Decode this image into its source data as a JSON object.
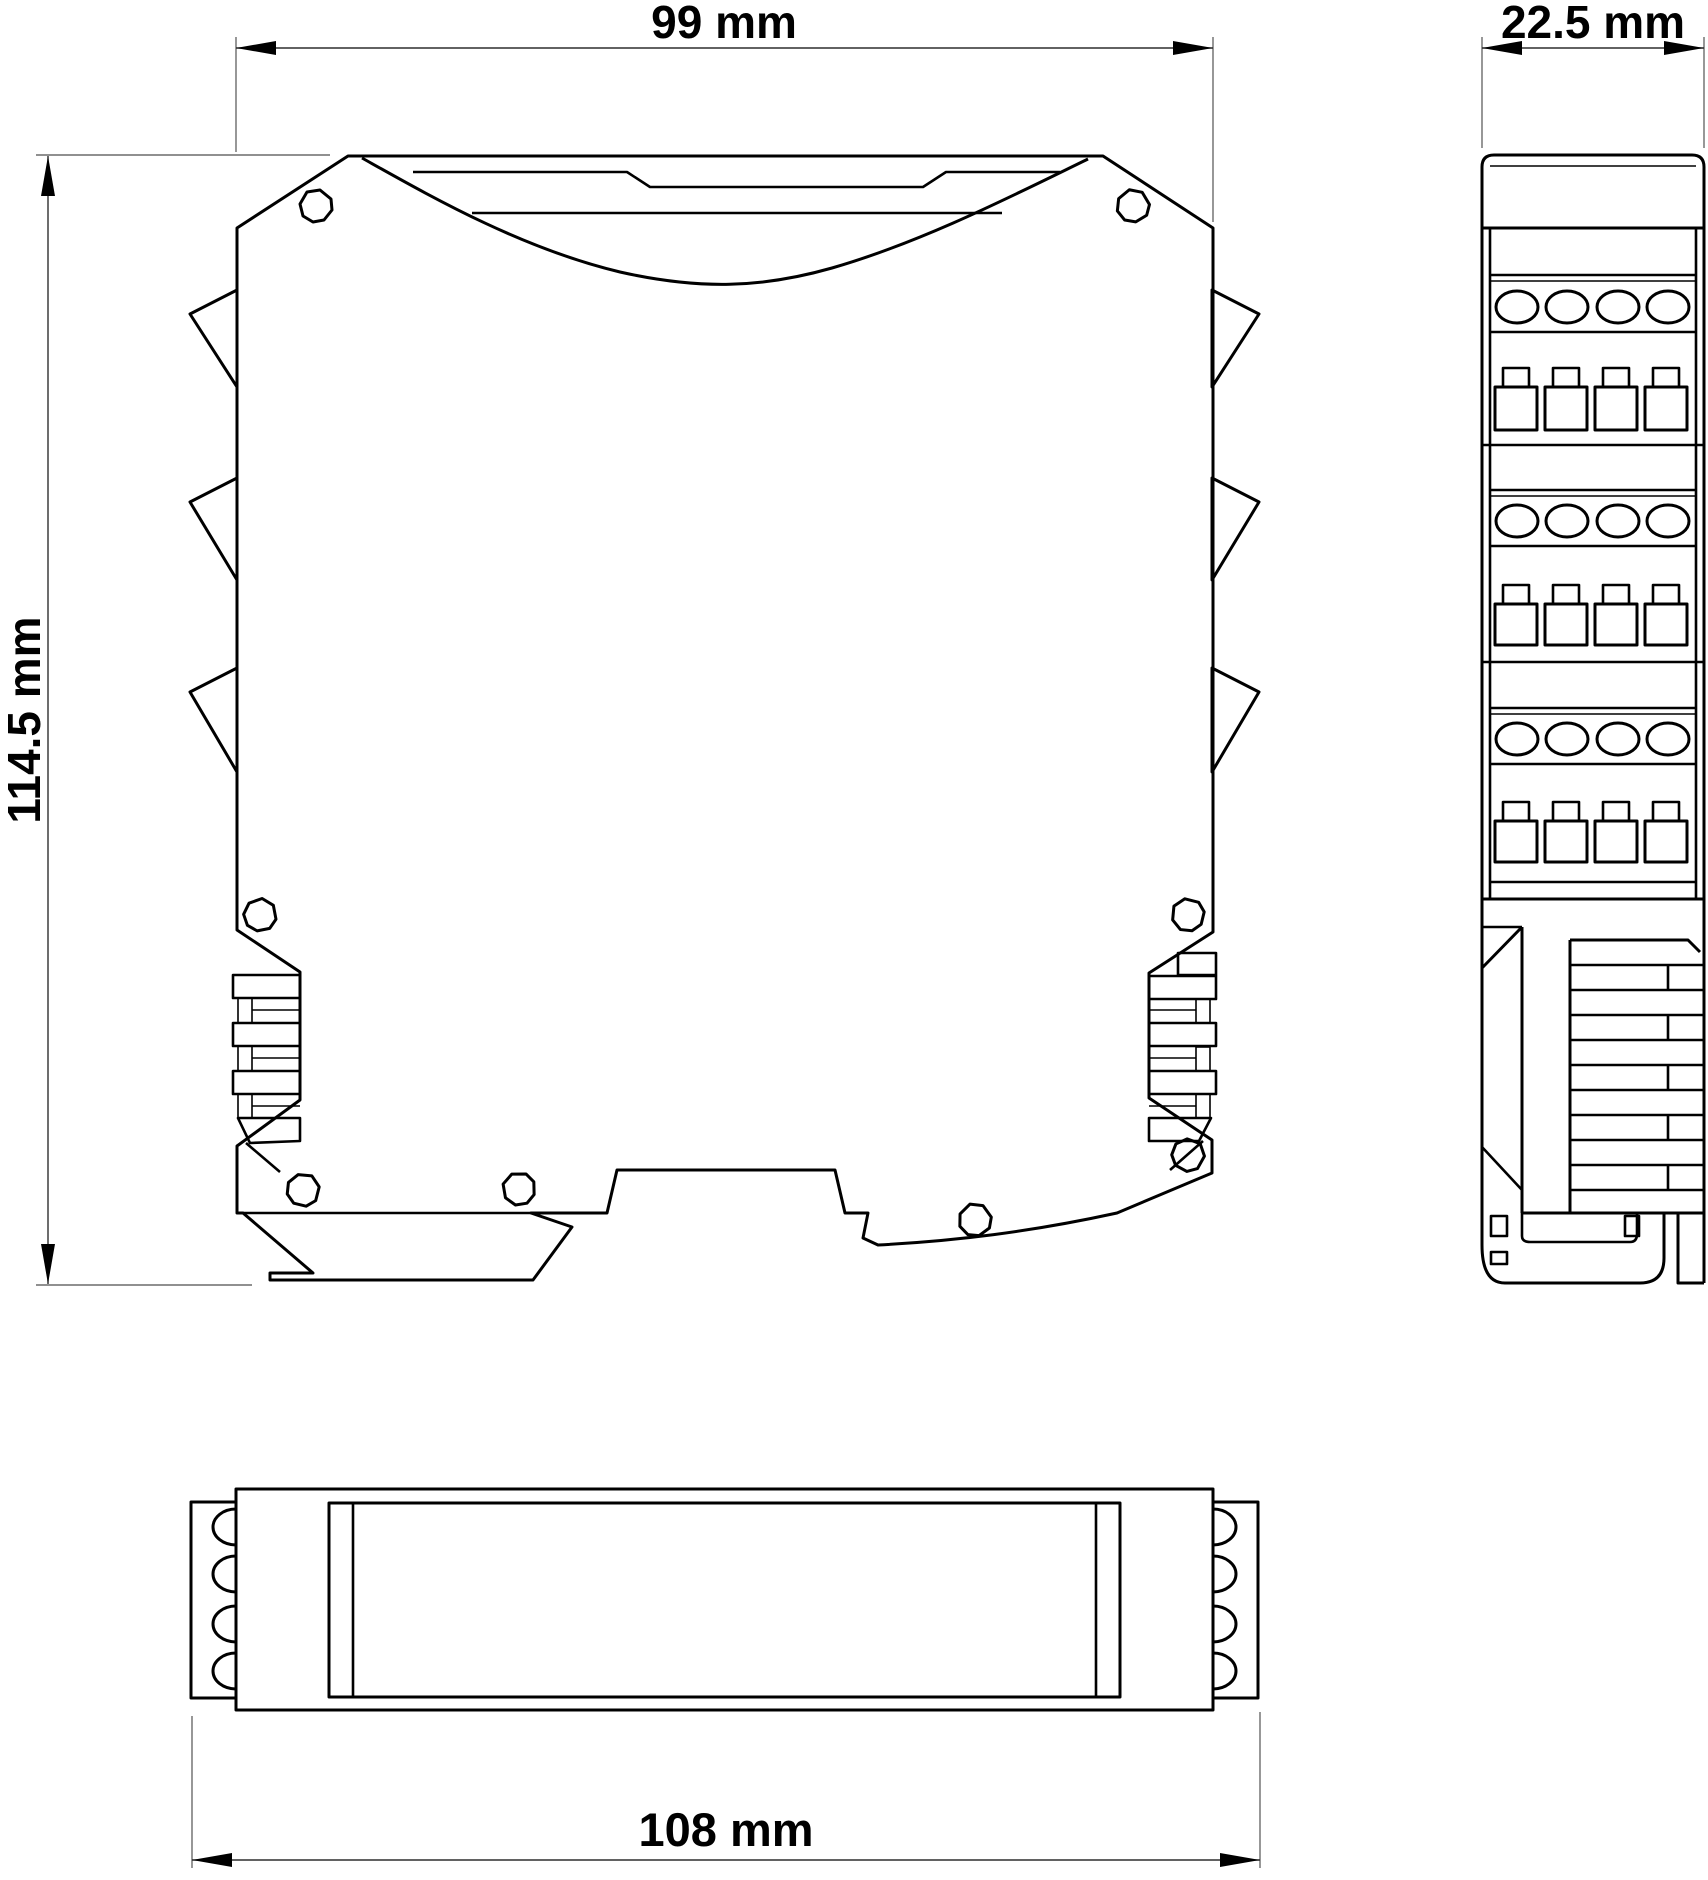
{
  "drawing": {
    "title": "DIN-rail module dimensional drawing",
    "background_color": "#ffffff",
    "line_color": "#000000",
    "dimension_line_color": "#2f2f2f",
    "views": {
      "front": {
        "name": "front view",
        "features": [
          "label recess",
          "3 side spacer tabs per side",
          "8 screw holes",
          "DIN-rail foot"
        ]
      },
      "side": {
        "name": "side view",
        "features": [
          "3 terminal levels",
          "4 screw heads per level",
          "4 wire entries per level",
          "DIN-rail clip"
        ]
      },
      "bottom": {
        "name": "bottom view",
        "features": [
          "terminal block left",
          "terminal block right",
          "label window"
        ]
      }
    },
    "dimensions": [
      {
        "id": "width_top",
        "label": "99 mm",
        "value": 99,
        "unit": "mm",
        "applies_to": "front view width"
      },
      {
        "id": "depth",
        "label": "22.5 mm",
        "value": 22.5,
        "unit": "mm",
        "applies_to": "side view width"
      },
      {
        "id": "height",
        "label": "114.5 mm",
        "value": 114.5,
        "unit": "mm",
        "applies_to": "front view height"
      },
      {
        "id": "width_bottom",
        "label": "108 mm",
        "value": 108,
        "unit": "mm",
        "applies_to": "bottom view overall width"
      }
    ]
  }
}
